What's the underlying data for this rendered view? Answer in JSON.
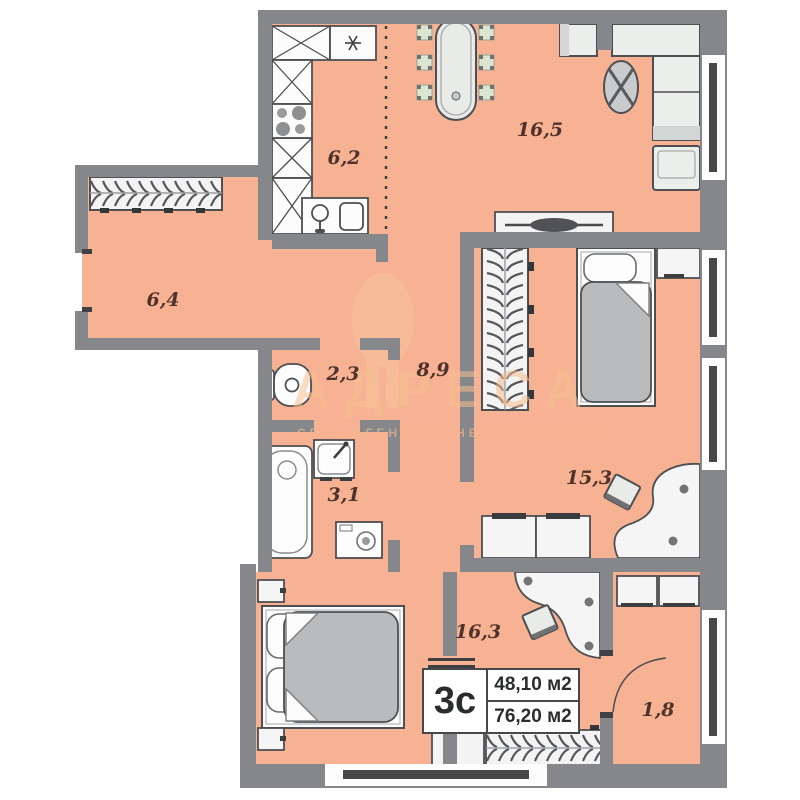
{
  "info": {
    "type": "3с",
    "living_area": "48,10 м2",
    "total_area": "76,20 м2"
  },
  "rooms": [
    {
      "id": "kitchen",
      "area_label": "6,2"
    },
    {
      "id": "living-room",
      "area_label": "16,5"
    },
    {
      "id": "hallway",
      "area_label": "6,4"
    },
    {
      "id": "wc",
      "area_label": "2,3"
    },
    {
      "id": "corridor",
      "area_label": "8,9"
    },
    {
      "id": "bathroom",
      "area_label": "3,1"
    },
    {
      "id": "bedroom-right",
      "area_label": "15,3"
    },
    {
      "id": "bedroom-bottom",
      "area_label": "16,3"
    },
    {
      "id": "balcony",
      "area_label": "1,8"
    }
  ],
  "watermark": {
    "brand": "АДРЕСА",
    "tagline": "СЕТЬ АГЕНТСТВ НЕДВИЖИМОСТИ"
  },
  "colors": {
    "floor": "#f6b292",
    "wall": "#85878a",
    "furniture_stroke": "#4e4f53",
    "chair_green": "#dbe6d2",
    "blanket": "#b9bbbd",
    "watermark": "#f6bf92",
    "label_text": "#4f322b",
    "window_dark": "#47484a"
  }
}
